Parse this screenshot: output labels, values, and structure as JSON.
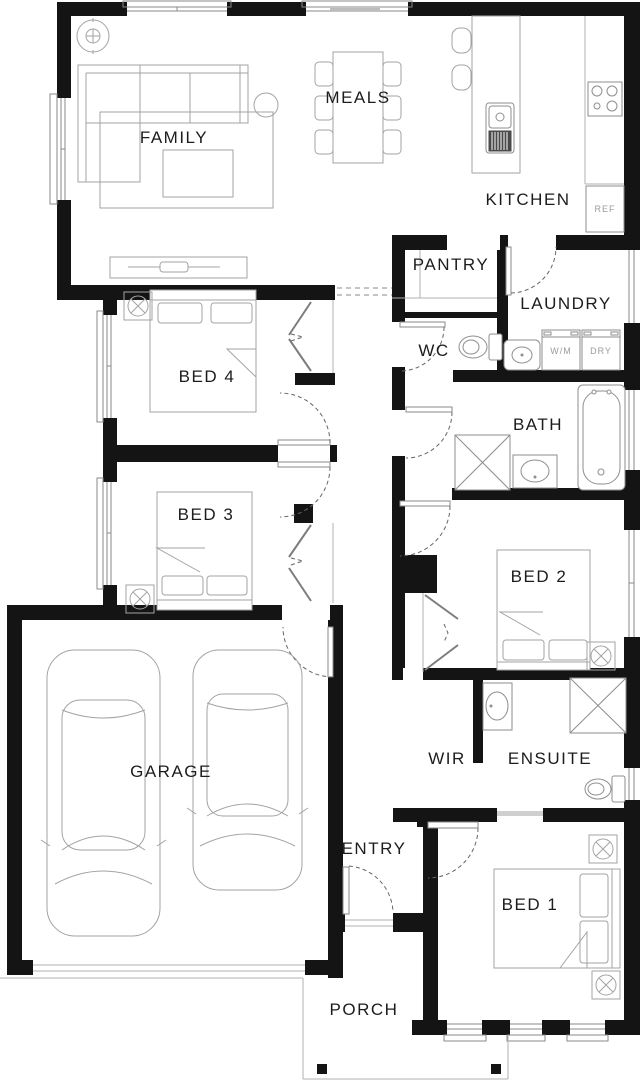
{
  "plan": {
    "type": "residential-floor-plan",
    "rooms": [
      {
        "id": "family",
        "label": "FAMILY"
      },
      {
        "id": "meals",
        "label": "MEALS"
      },
      {
        "id": "kitchen",
        "label": "KITCHEN"
      },
      {
        "id": "pantry",
        "label": "PANTRY"
      },
      {
        "id": "laundry",
        "label": "LAUNDRY"
      },
      {
        "id": "wc",
        "label": "WC"
      },
      {
        "id": "bed4",
        "label": "BED 4"
      },
      {
        "id": "bath",
        "label": "BATH"
      },
      {
        "id": "bed3",
        "label": "BED 3"
      },
      {
        "id": "bed2",
        "label": "BED 2"
      },
      {
        "id": "garage",
        "label": "GARAGE"
      },
      {
        "id": "wir",
        "label": "WIR"
      },
      {
        "id": "ensuite",
        "label": "ENSUITE"
      },
      {
        "id": "entry",
        "label": "ENTRY"
      },
      {
        "id": "bed1",
        "label": "BED 1"
      },
      {
        "id": "porch",
        "label": "PORCH"
      }
    ],
    "appliances": {
      "fridge": "REF",
      "washer": "W/M",
      "dryer": "DRY"
    },
    "colors": {
      "wall": "#141414",
      "furniture_line": "#a3a3a3",
      "fixture_line": "#8e8e8e",
      "room_label": "#1c1c1c",
      "appliance_label": "#9b9b9b",
      "door_swing": "#666666",
      "background": "#ffffff"
    }
  }
}
